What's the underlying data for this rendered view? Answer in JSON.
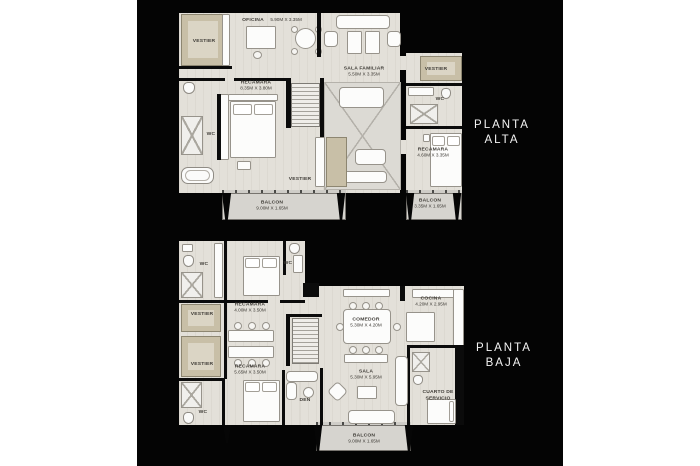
{
  "poster": {
    "page_bg": "#ffffff",
    "poster_bg": "#040404"
  },
  "planta_alta": {
    "title_line1": "PLANTA",
    "title_line2": "ALTA",
    "rooms": {
      "vestier_nw": {
        "name": "VESTIER"
      },
      "oficina": {
        "name": "OFICINA",
        "dims": "5.90M X 3.35M"
      },
      "sala_familiar": {
        "name": "SALA FAMILIAR",
        "dims": "5.50M X 3.35M"
      },
      "recamara_principal": {
        "name": "RECAMARA",
        "dims": "8.35M X 3.80M"
      },
      "wc_w": {
        "name": "WC"
      },
      "vestier_center": {
        "name": "VESTIER"
      },
      "vestier_e": {
        "name": "VESTIER"
      },
      "wc_e": {
        "name": "WC"
      },
      "recamara_e": {
        "name": "RECAMARA",
        "dims": "4.60M X 3.35M"
      },
      "balcon_main": {
        "name": "BALCON",
        "dims": "9.00M X 1.65M"
      },
      "balcon_e": {
        "name": "BALCON",
        "dims": "3.35M X 1.65M"
      }
    }
  },
  "planta_baja": {
    "title_line1": "PLANTA",
    "title_line2": "BAJA",
    "rooms": {
      "wc_nw": {
        "name": "WC"
      },
      "recamara_n": {
        "name": "RECAMARA",
        "dims": "4.00M X 3.50M"
      },
      "wc_n": {
        "name": "WC"
      },
      "vestier_1": {
        "name": "VESTIER"
      },
      "vestier_2": {
        "name": "VESTIER"
      },
      "recamara_s": {
        "name": "RECAMARA",
        "dims": "5.65M X 3.50M"
      },
      "wc_sw": {
        "name": "WC"
      },
      "cocina": {
        "name": "COCINA",
        "dims": "4.20M X 2.95M"
      },
      "comedor": {
        "name": "COMEDOR",
        "dims": "5.30M X 4.20M"
      },
      "sala": {
        "name": "SALA",
        "dims": "5.30M X 5.95M"
      },
      "den": {
        "name": "DEN"
      },
      "cuarto_servicio": {
        "name": "CUARTO DE",
        "name2": "SERVICIO"
      },
      "balcon": {
        "name": "BALCON",
        "dims": "9.00M X 1.65M"
      }
    }
  }
}
